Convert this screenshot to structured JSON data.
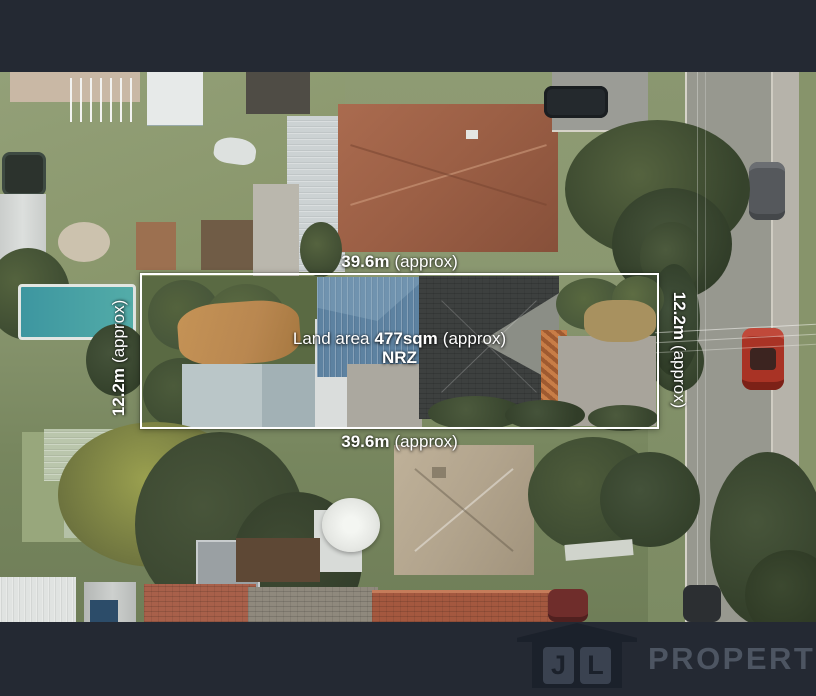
{
  "annotations": {
    "top": {
      "bold": "39.6m",
      "rest": "(approx)"
    },
    "bottom": {
      "bold": "39.6m",
      "rest": "(approx)"
    },
    "left": {
      "bold": "12.2m",
      "rest": "(approx)"
    },
    "right": {
      "bold": "12.2m",
      "rest": "(approx)"
    },
    "area": {
      "prefix": "Land area",
      "bold": "477sqm",
      "rest": "(approx)"
    },
    "zoning": "NRZ"
  },
  "branding": {
    "monogram": [
      "J",
      "L"
    ],
    "wordmark": "PROPERTY"
  },
  "colors": {
    "boundary_outline": "#ffffff",
    "letterbox": "#242933",
    "logo_house": "#1b212b",
    "logo_panel": "#3a4250",
    "wordmark_text": "#4d5562",
    "pool": "#49a2a4",
    "road": "#97988f",
    "blue_roof": "#5d82a1",
    "terracotta_roof": "#9b5f45"
  }
}
